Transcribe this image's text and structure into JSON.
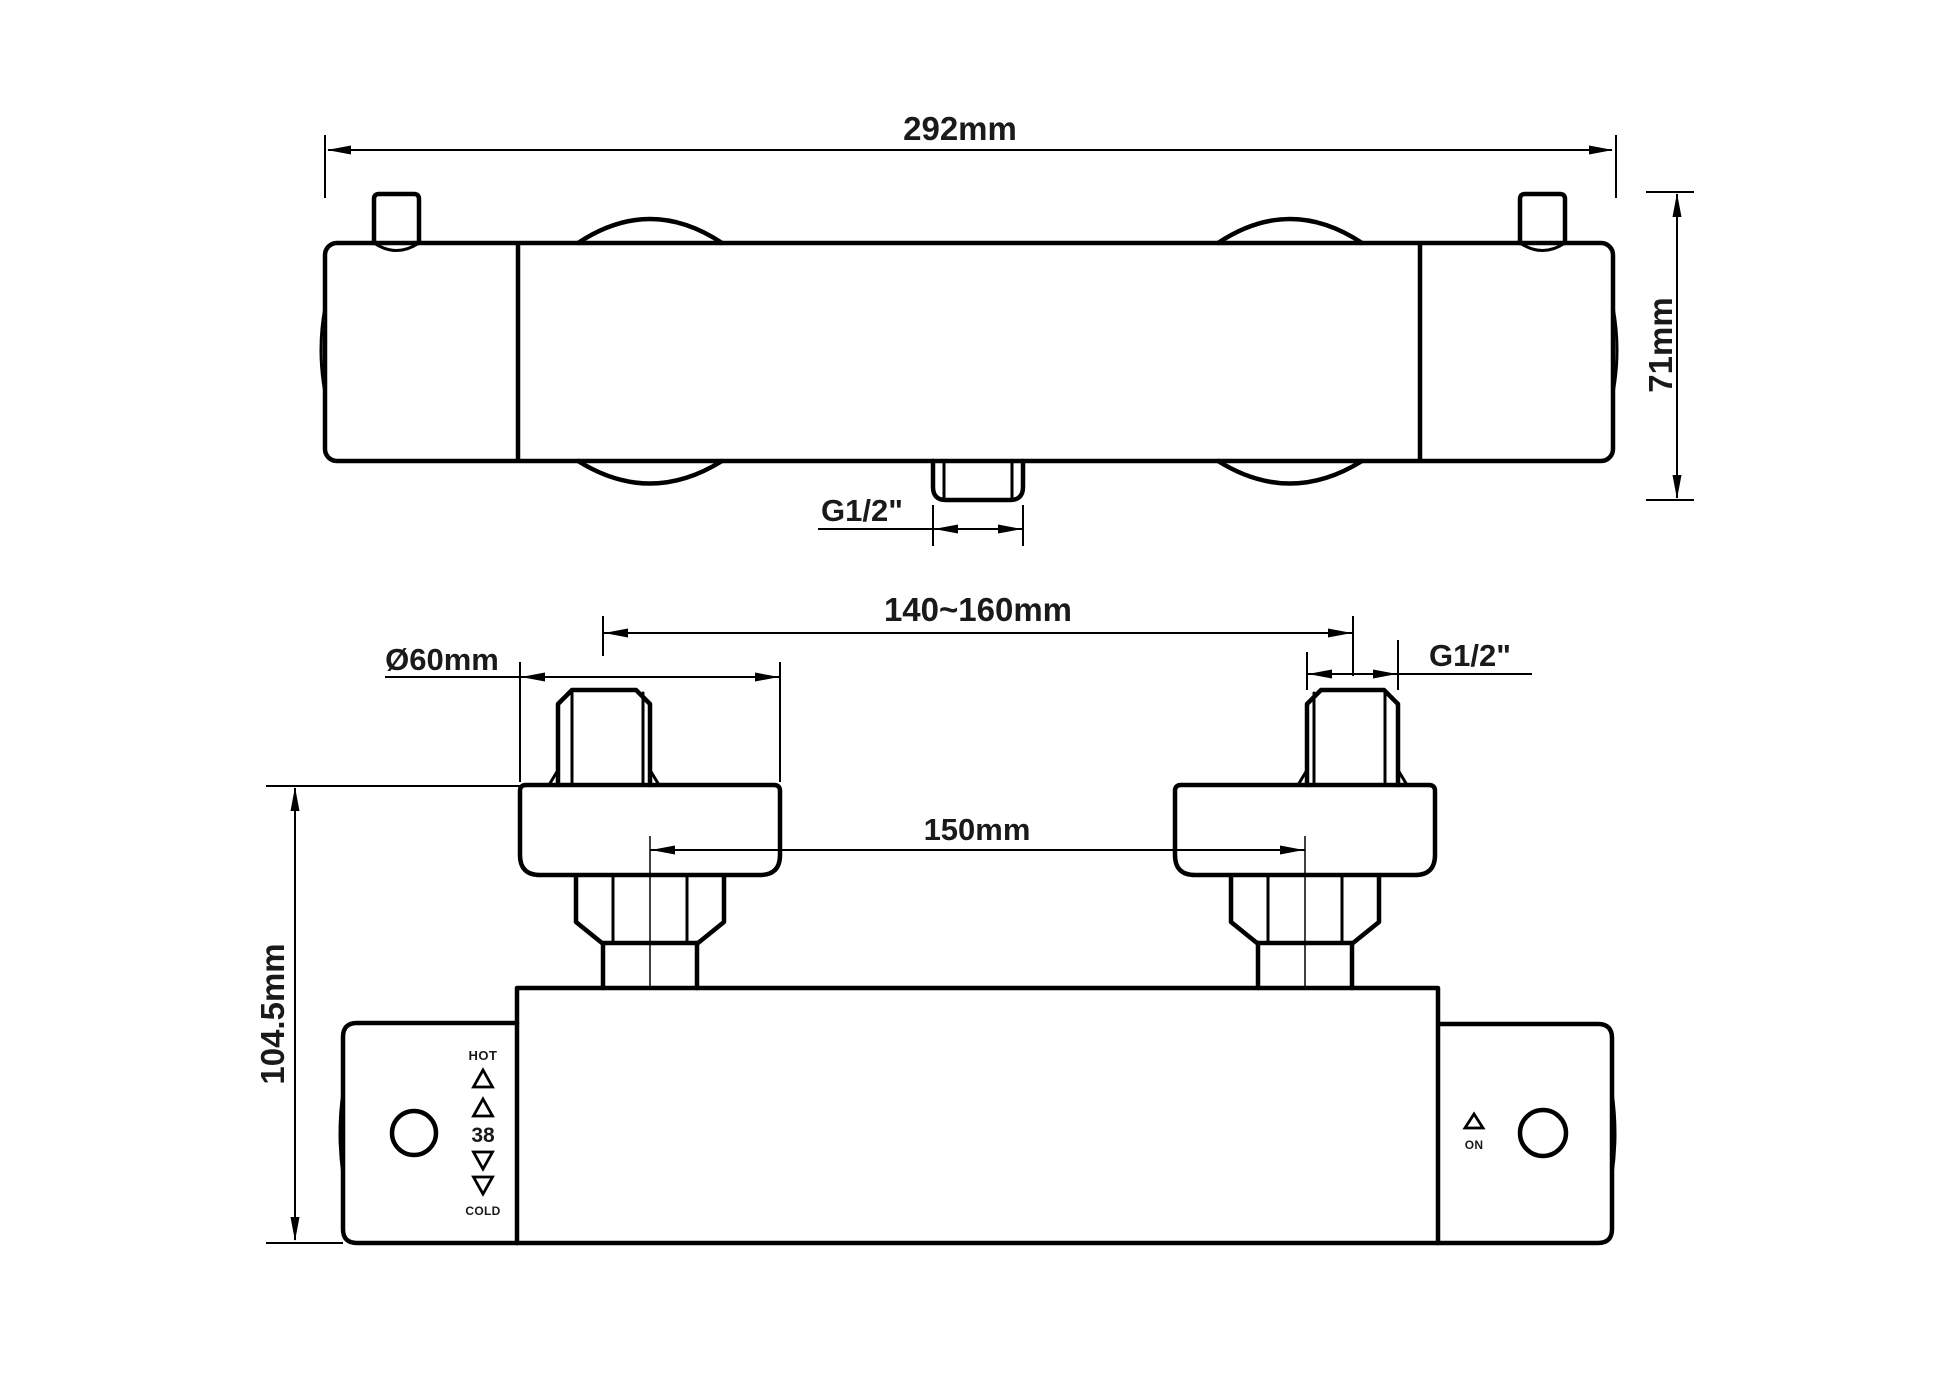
{
  "drawing": {
    "type": "technical-drawing",
    "subject": "thermostatic shower mixer bar valve",
    "background_color": "#ffffff",
    "line_color": "#000000",
    "top_view": {
      "width_dim": "292mm",
      "height_dim": "71mm",
      "outlet_thread_dim": "G1/2\""
    },
    "front_view": {
      "wall_inlet_span_dim": "140~160mm",
      "escutcheon_diameter_dim": "Ø60mm",
      "inlet_thread_dim": "G1/2\"",
      "valve_inlet_span_dim": "150mm",
      "height_dim": "104.5mm",
      "temperature_handle": {
        "hot_label": "HOT",
        "temperature_label": "38",
        "cold_label": "COLD"
      },
      "flow_handle": {
        "on_label": "ON"
      }
    }
  }
}
